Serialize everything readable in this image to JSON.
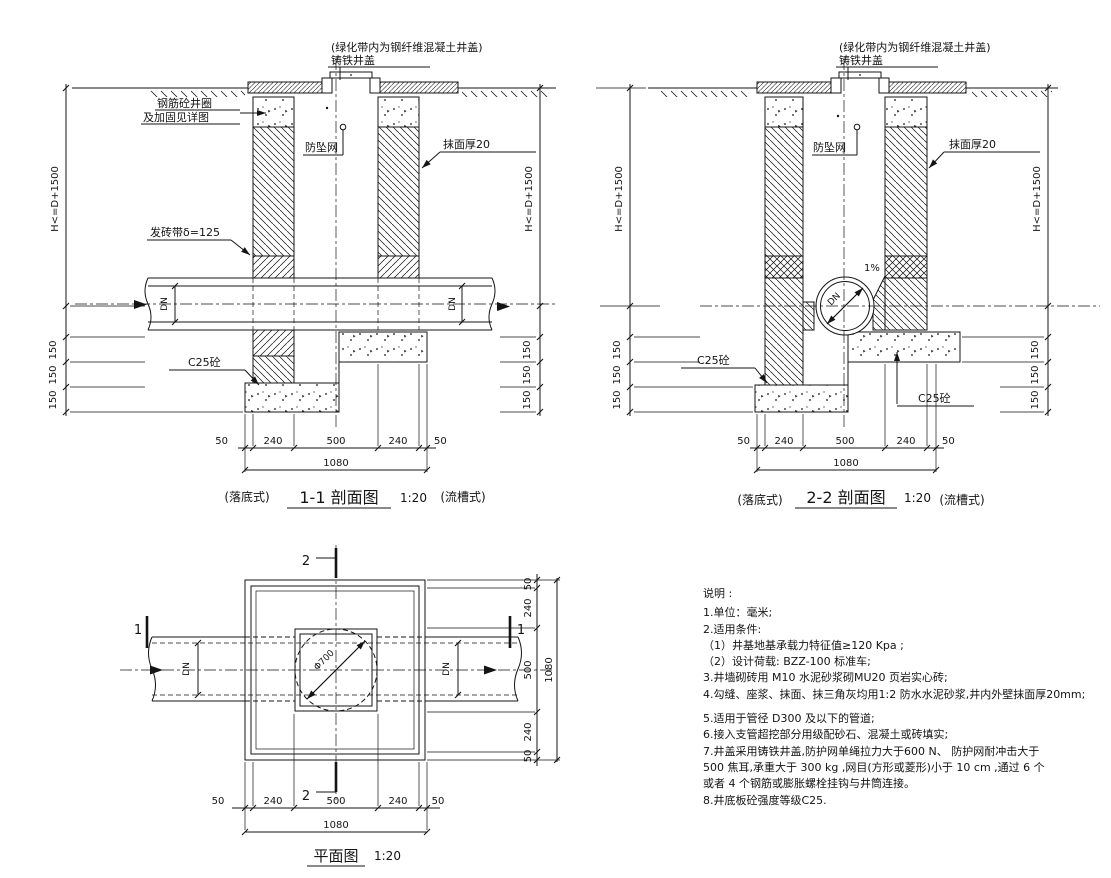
{
  "common": {
    "top_note": "(绿化带内为钢纤维混凝土井盖)",
    "cover_label": "铸铁井盖",
    "net_label": "防坠网",
    "plaster_label": "抹面厚20",
    "concrete_label": "C25砼",
    "height_dim": "H<=D+1500",
    "dim150": "150",
    "dn": "DN",
    "dim50": "50",
    "dim240": "240",
    "dim500": "500",
    "dim1080": "1080",
    "scale": "1:20",
    "type_left": "(落底式)",
    "type_right": "(流槽式)"
  },
  "section1": {
    "ring_label_line1": "钢筋砼井圈",
    "ring_label_line2": "及加固见详图",
    "brick_band_label": "发砖带δ=125",
    "title": "1-1  剖面图"
  },
  "section2": {
    "slope_label": "1%",
    "title": "2-2  剖面图"
  },
  "plan": {
    "title": "平面图",
    "marker_1": "1",
    "marker_2": "2",
    "circle_label": "Φ700"
  },
  "notes": {
    "title": "说明 :",
    "lines": [
      "1.单位：毫米;",
      "2.适用条件:",
      "（1）井基地基承载力特征值≥120 Kpa    ;",
      "（2）设计荷载:     BZZ-100      标准车;",
      "3.井墙砌砖用 M10   水泥砂浆砌MU20    页岩实心砖;",
      "4.勾缝、座浆、抹面、抹三角灰均用1:2   防水水泥砂浆,井内外壁抹面厚20mm;",
      "5.适用于管径   D300     及以下的管道;",
      "6.接入支管超挖部分用级配砂石、混凝土或砖填实;",
      "7.井盖采用铸铁井盖,防护网单绳拉力大于600 N、   防护网耐冲击大于",
      "500   焦耳,承重大于 300 kg    ,网目(方形或菱形)小于 10 cm   ,通过  6 个",
      "或者 4 个钢筋或膨胀螺栓挂钩与井筒连接。",
      "8.井底板砼强度等级C25."
    ]
  }
}
